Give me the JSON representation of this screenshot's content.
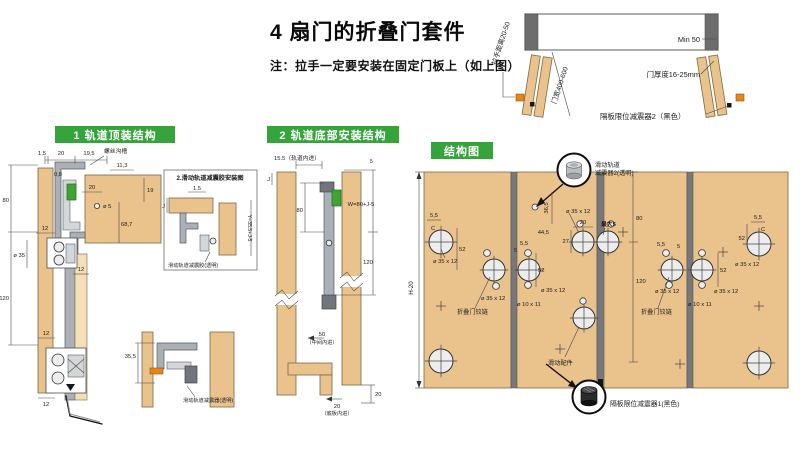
{
  "colors": {
    "header_green": "#35a43b",
    "damper_green": "#3fa433",
    "wood": "#e9c28c",
    "wood_light": "#f5dfb8",
    "metal_gray": "#aab0b6",
    "handle_orange": "#e8861c",
    "callout_black": "#161616"
  },
  "title_block": {
    "title": "4 扇门的折叠门套件",
    "note": "注：拉手一定要安装在固定门板上（如上图）"
  },
  "overview": {
    "handle_distance": "拉手距离20-50",
    "door_width": "门宽400-600",
    "min_gap": "Min 50",
    "door_thickness": "门厚度16-25mm",
    "damper2": "隔板限位减震器2（黑色）"
  },
  "s1": {
    "header": "1 轨道顶装结构",
    "screw_groove": "螺丝沟槽",
    "d_15": "1,5",
    "d_20a": "20",
    "d_195": "19,5",
    "d_113": "11,3",
    "d_08": "0,8",
    "d_20b": "20",
    "d_19": "19",
    "d_o5": "ø 5",
    "d_687": "68,7",
    "d_80": "80",
    "d_120": "120",
    "d_o35": "ø 35",
    "d_12a": "12",
    "d_12b": "12",
    "d_12c": "12",
    "d_12d": "12",
    "inset": {
      "title": "2.滑动轨道减震胶安装图",
      "d_15": "1.5",
      "d_j": "J",
      "d_y": "Y=35.5+J-5",
      "label": "滑动轨道减震胶(透明)"
    },
    "detail": {
      "d_355": "35,5",
      "label": "滑动轨道减震器(透明)"
    }
  },
  "s2": {
    "header": "2 轨道底部安装结构",
    "d_155": "15.5（轨道内进）",
    "d_j": "J",
    "d_80": "80",
    "d_5": "5",
    "d_w": "W=80+J-5",
    "d_120": "120",
    "d_50": "50",
    "d_50note": "（中间内进）",
    "d_20a": "20",
    "d_20b": "20",
    "d_20note": "（底板内进）"
  },
  "s3": {
    "header": "结构图",
    "d_h": "H-20",
    "callout_top_1": "滑动轨道",
    "callout_top_2": "减震器2(透明)",
    "callout_bottom": "隔板限位减震器1(黑色)",
    "hinge": "折叠门铰链",
    "slide": "滑动配件",
    "d_55": "5,5",
    "d_c": "C",
    "d_52": "52",
    "d_cup": "ø 35 x 12",
    "d_dowel": "ø 10 x 11",
    "d_365": "36,5",
    "d_445": "44,5",
    "d_20": "20",
    "d_27": "27",
    "d_max5": "最大5",
    "d_80": "80",
    "d_120": "120",
    "d_5": "5"
  }
}
